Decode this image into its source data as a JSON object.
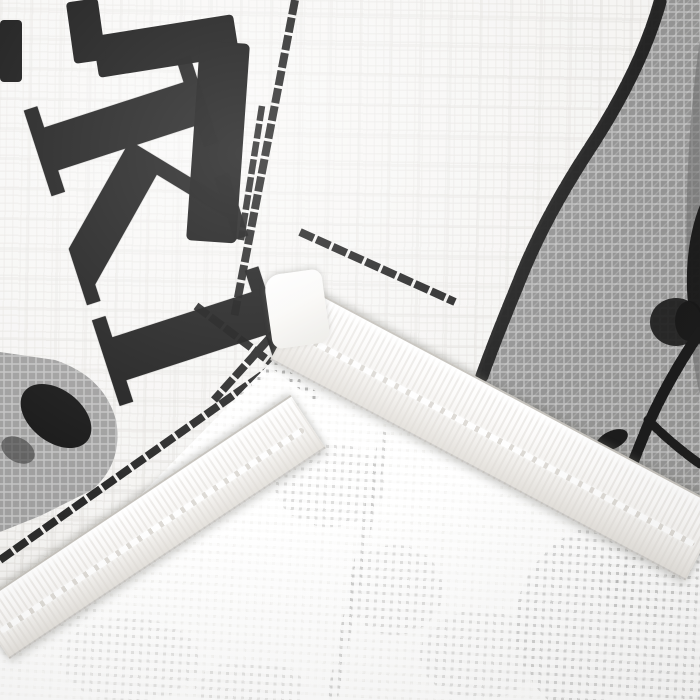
{
  "scene": {
    "description": "Macro photo of a white waffle-weave kitchen towel: large black printed serif letters and thin printed rule lines at top left, a gray printed illustration area on the right, and the stitched hem corner of a folded towel layer crossing the lower half of the frame"
  },
  "print": {
    "visible_text": "KI",
    "text_color": "#191919",
    "rule_line_color": "#1c1c1c",
    "illustration_gray": "#8d8d8d",
    "patch_gray": "#979797"
  },
  "fabric": {
    "base_white": "#f5f4f2",
    "hem_white": "#ffffff",
    "hem_shadow": "#d8d5d0",
    "weave_shadow": "#e3e1dd"
  }
}
